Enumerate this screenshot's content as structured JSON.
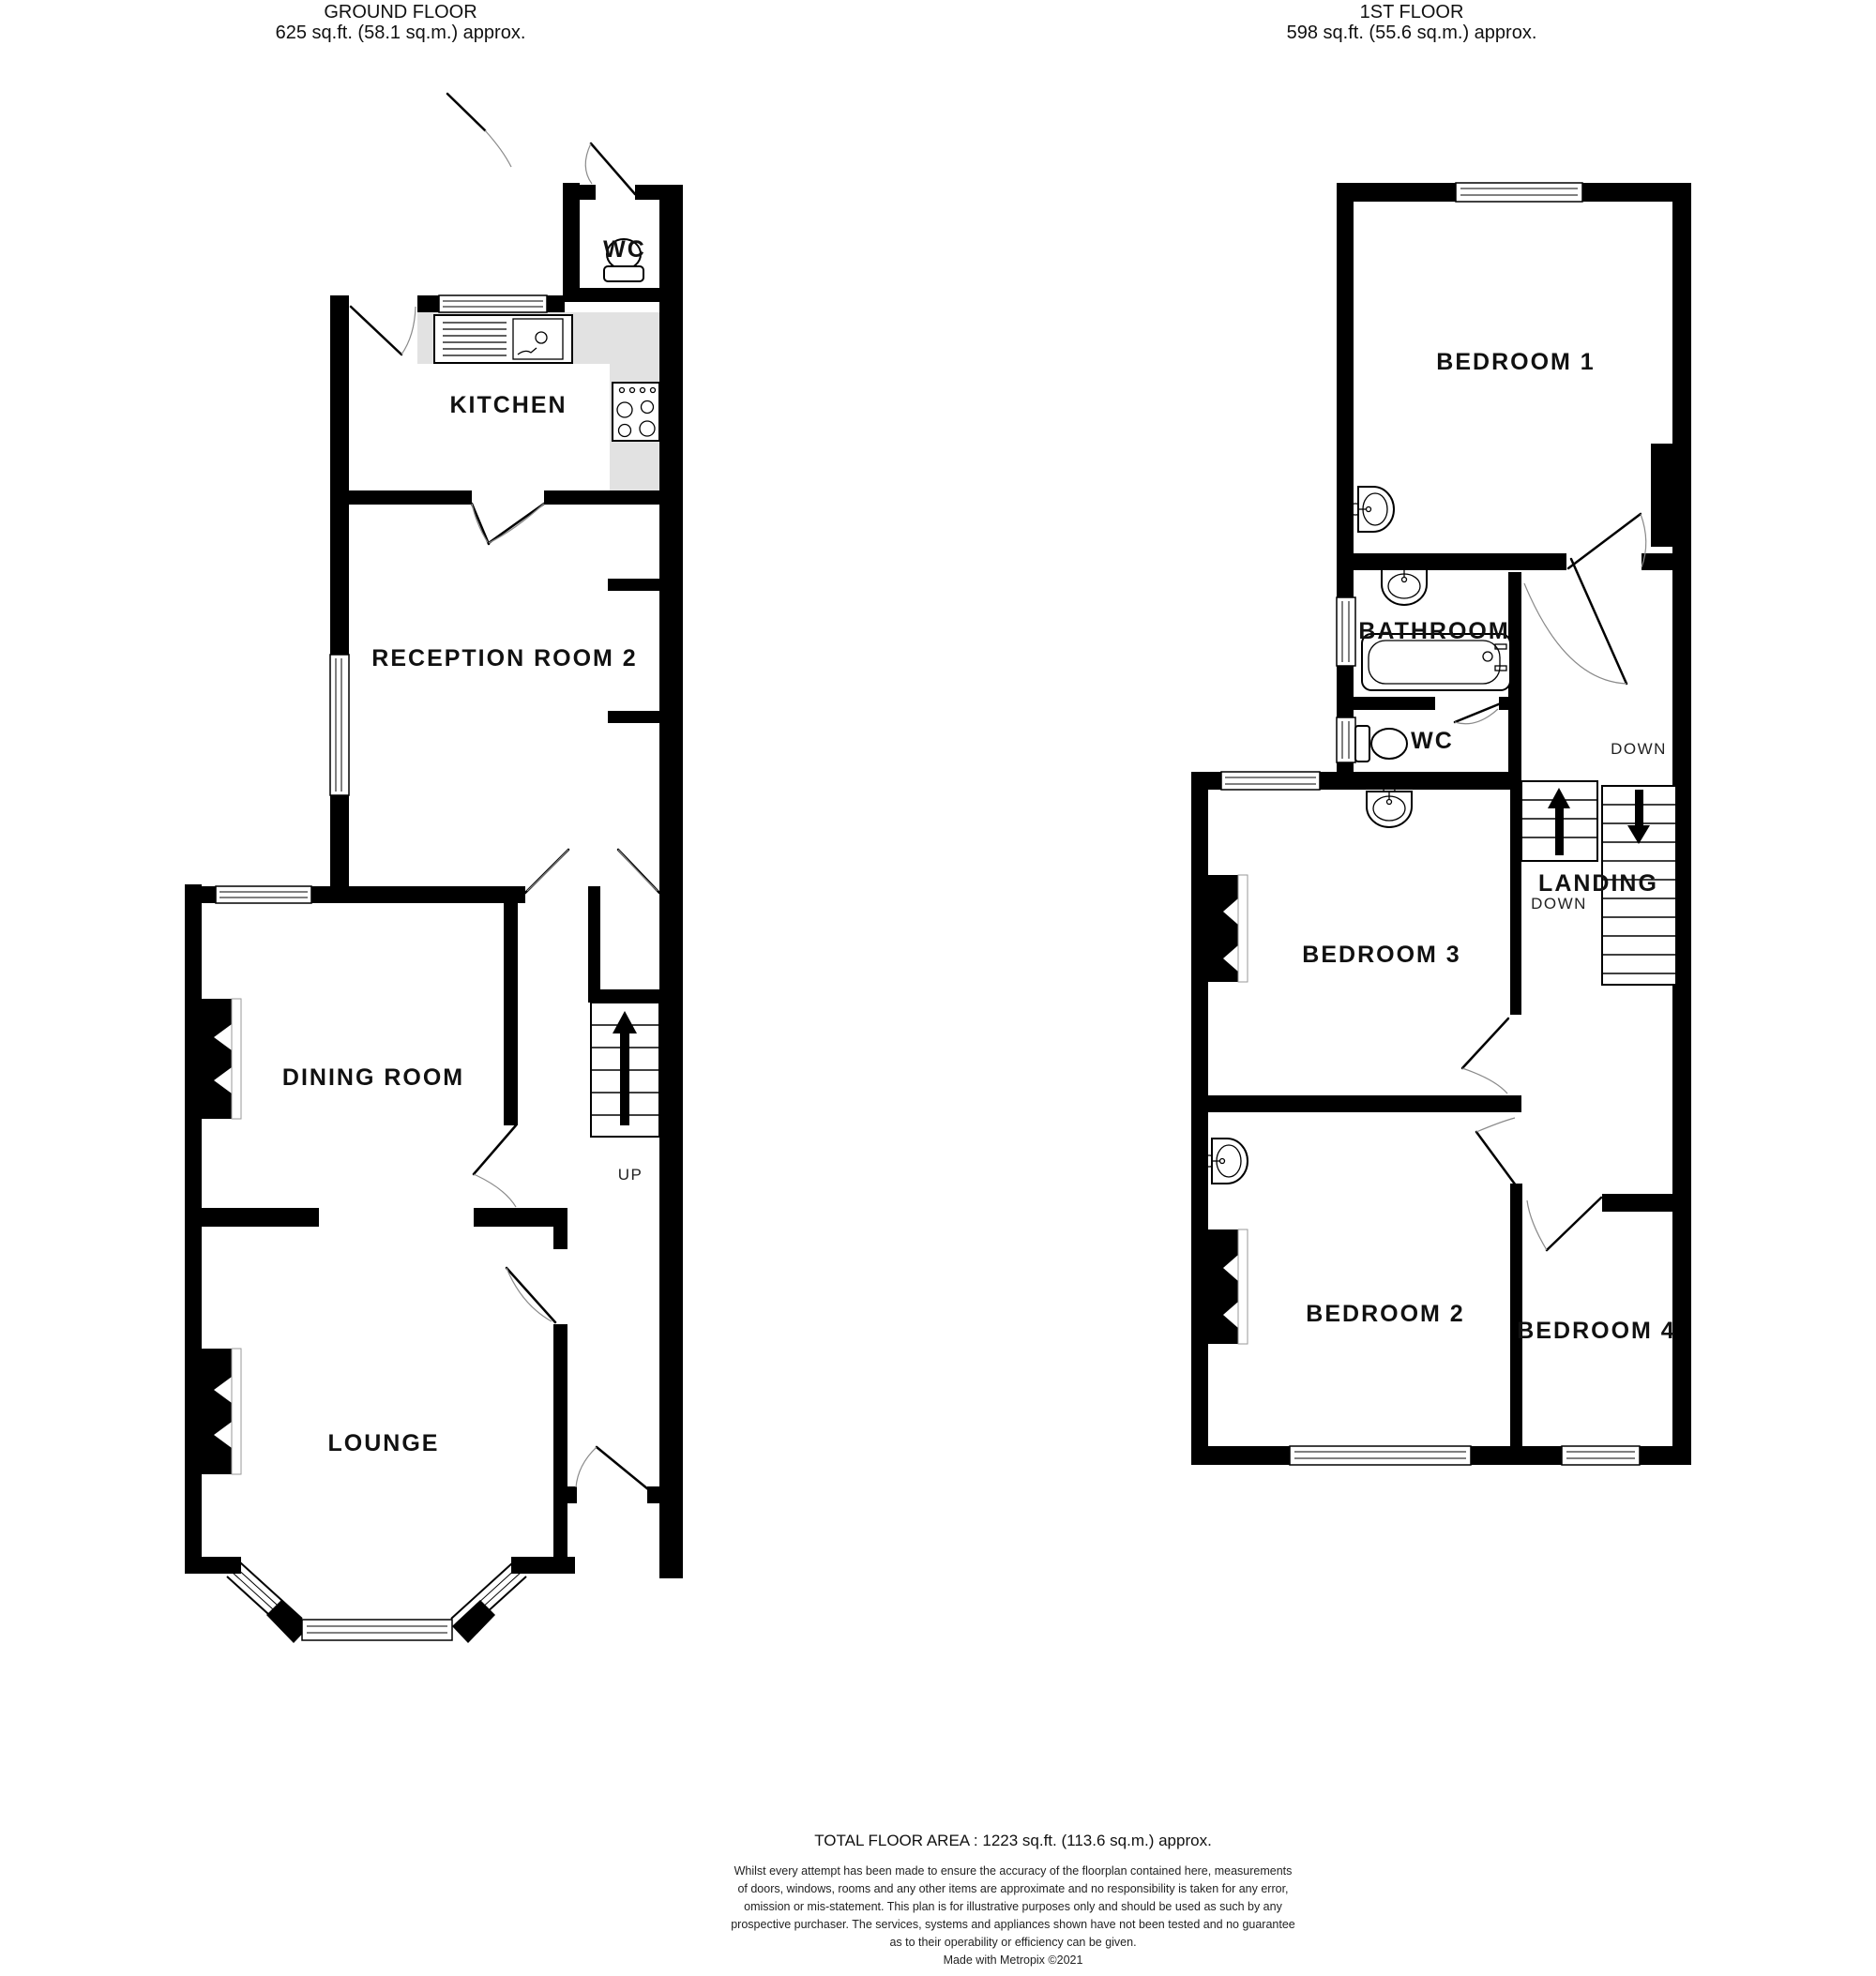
{
  "ground_floor": {
    "title": "GROUND FLOOR",
    "area": "625 sq.ft. (58.1 sq.m.) approx.",
    "rooms": {
      "wc": "WC",
      "kitchen": "KITCHEN",
      "reception2": "RECEPTION ROOM 2",
      "dining": "DINING ROOM",
      "lounge": "LOUNGE"
    },
    "stairs": {
      "up": "UP"
    }
  },
  "first_floor": {
    "title": "1ST FLOOR",
    "area": "598 sq.ft. (55.6 sq.m.) approx.",
    "rooms": {
      "bedroom1": "BEDROOM 1",
      "bathroom": "BATHROOM",
      "wc": "WC",
      "landing": "LANDING",
      "bedroom3": "BEDROOM 3",
      "bedroom2": "BEDROOM 2",
      "bedroom4": "BEDROOM 4"
    },
    "stairs": {
      "down_top": "DOWN",
      "down_bottom": "DOWN"
    }
  },
  "footer": {
    "total_area": "TOTAL FLOOR AREA : 1223 sq.ft. (113.6 sq.m.) approx.",
    "disclaimer_lines": [
      "Whilst every attempt has been made to ensure the accuracy of the floorplan contained here, measurements",
      "of doors, windows, rooms and any other items are approximate and no responsibility is taken for any error,",
      "omission or mis-statement. This plan is for illustrative purposes only and should be used as such by any",
      "prospective purchaser. The services, systems and appliances shown have not been tested and no guarantee",
      "as to their operability or efficiency can be given."
    ],
    "credit": "Made with Metropix ©2021"
  },
  "colors": {
    "wall": "#000000",
    "counter": "#e2e2e2",
    "background": "#ffffff"
  }
}
